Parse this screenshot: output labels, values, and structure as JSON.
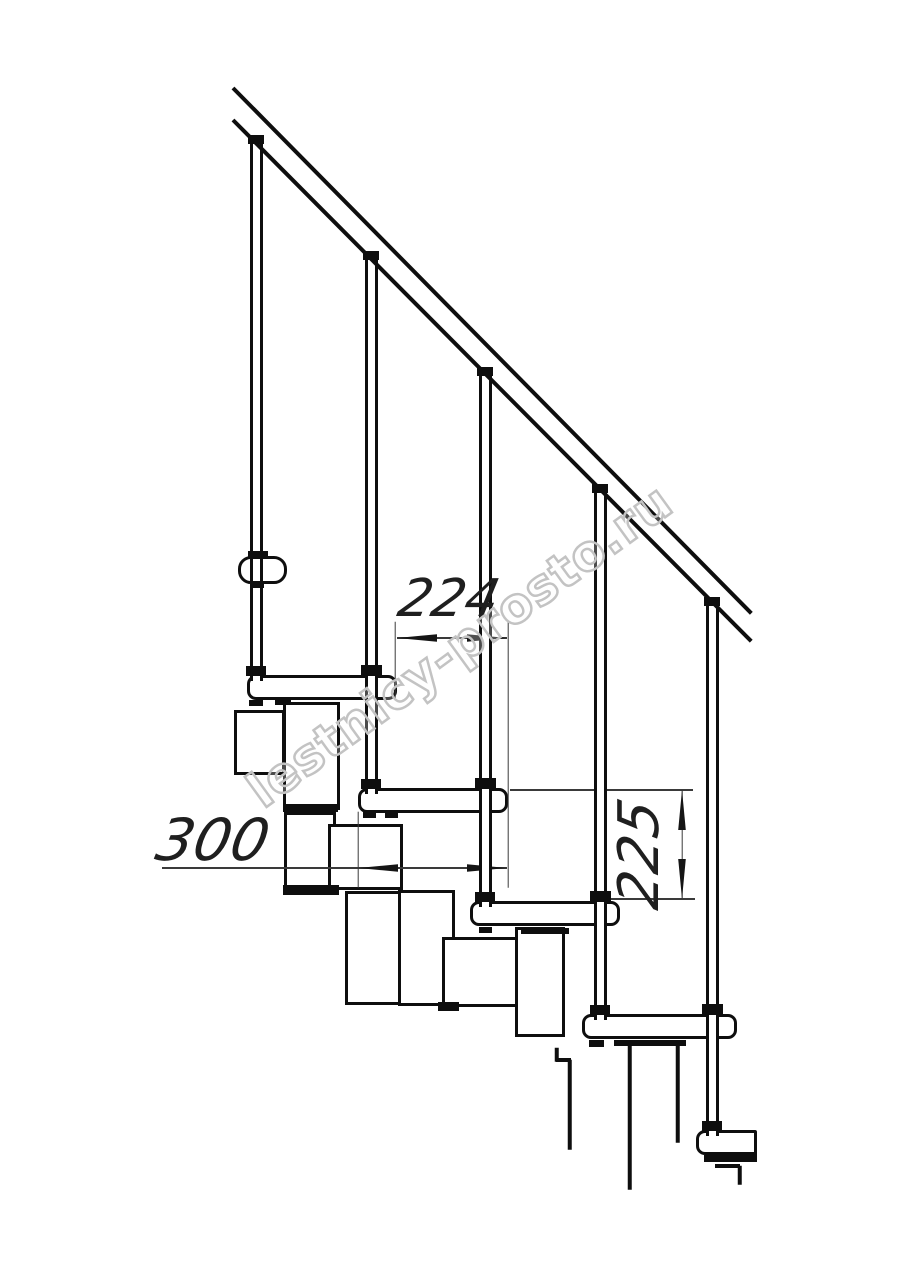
{
  "meta": {
    "description": "Technical side-view line drawing of a modular staircase with handrail, balusters, treads and central support modules",
    "background_color": "#ffffff",
    "object_line_color": "#0e0e0e",
    "thin_line_color": "#3a3a3a",
    "canvas": {
      "width": 914,
      "height": 1280
    }
  },
  "watermark": {
    "text": "lestnicy-prosto.ru",
    "center": {
      "x": 460,
      "y": 646
    },
    "angle_deg": -36,
    "font_size": 49,
    "letter_spacing": 1,
    "stroke_color": "#c3c3c3"
  },
  "dimensions": {
    "going": {
      "label": "224",
      "value_mm": 224,
      "text_center": {
        "x": 449,
        "y": 599
      },
      "font_size": 52,
      "rotate_deg": 0,
      "line": {
        "x1": 397,
        "y1": 638,
        "x2": 507,
        "y2": 638
      },
      "extension_lines": [
        {
          "x1": 395,
          "y1": 622,
          "x2": 395,
          "y2": 700
        },
        {
          "x1": 508,
          "y1": 622,
          "x2": 508,
          "y2": 888
        }
      ],
      "arrows": [
        {
          "x": 397,
          "y": 638,
          "dir": "left"
        },
        {
          "x": 507,
          "y": 638,
          "dir": "right"
        }
      ]
    },
    "tread_depth": {
      "label": "300",
      "value_mm": 300,
      "text_center": {
        "x": 213,
        "y": 840
      },
      "font_size": 58,
      "rotate_deg": 0,
      "line": {
        "x1": 162,
        "y1": 868,
        "x2": 507,
        "y2": 868
      },
      "extension_lines": [
        {
          "x1": 358,
          "y1": 812,
          "x2": 358,
          "y2": 888
        }
      ],
      "arrows": [
        {
          "x": 358,
          "y": 868,
          "dir": "left"
        },
        {
          "x": 507,
          "y": 868,
          "dir": "right"
        }
      ]
    },
    "rise": {
      "label": "225",
      "value_mm": 225,
      "text_center": {
        "x": 640,
        "y": 854
      },
      "font_size": 56,
      "rotate_deg": -90,
      "line": {
        "x1": 682,
        "y1": 790,
        "x2": 682,
        "y2": 899
      },
      "extension_lines": [
        {
          "x1": 510,
          "y1": 790,
          "x2": 693,
          "y2": 790
        },
        {
          "x1": 600,
          "y1": 899,
          "x2": 695,
          "y2": 899
        }
      ],
      "arrows": [
        {
          "x": 682,
          "y": 790,
          "dir": "up"
        },
        {
          "x": 682,
          "y": 899,
          "dir": "down"
        }
      ]
    }
  },
  "drawing": {
    "handrail": {
      "weight": 4,
      "upper": {
        "x1": 233,
        "y1": 88,
        "x2": 751,
        "y2": 613
      },
      "lower": {
        "x1": 233,
        "y1": 120,
        "x2": 751,
        "y2": 641
      }
    },
    "bracket_collar": {
      "x": 238,
      "y": 556,
      "w": 49,
      "h": 28
    },
    "balusters": [
      {
        "cx": 256,
        "top": 143,
        "bottom": 681
      },
      {
        "cx": 371,
        "top": 259,
        "bottom": 794
      },
      {
        "cx": 485,
        "top": 375,
        "bottom": 907
      },
      {
        "cx": 600,
        "top": 492,
        "bottom": 1020
      },
      {
        "cx": 712,
        "top": 605,
        "bottom": 1136
      }
    ],
    "baluster_width": 13,
    "treads": [
      {
        "x": 247,
        "y": 675,
        "w": 150,
        "h": 25,
        "r": "9px"
      },
      {
        "x": 358,
        "y": 788,
        "w": 150,
        "h": 25,
        "r": "9px"
      },
      {
        "x": 470,
        "y": 901,
        "w": 150,
        "h": 25,
        "r": "9px"
      },
      {
        "x": 582,
        "y": 1014,
        "w": 155,
        "h": 25,
        "r": "9px"
      },
      {
        "x": 696,
        "y": 1130,
        "w": 61,
        "h": 25,
        "r": "9px 2px 2px 9px"
      }
    ],
    "support_modules": [
      {
        "x": 234,
        "y": 710,
        "w": 51,
        "h": 65
      },
      {
        "x": 283,
        "y": 702,
        "w": 57,
        "h": 108
      },
      {
        "x": 284,
        "y": 812,
        "w": 52,
        "h": 82
      },
      {
        "x": 328,
        "y": 824,
        "w": 75,
        "h": 66
      },
      {
        "x": 345,
        "y": 891,
        "w": 58,
        "h": 114
      },
      {
        "x": 398,
        "y": 890,
        "w": 57,
        "h": 116
      },
      {
        "x": 442,
        "y": 937,
        "w": 78,
        "h": 70
      },
      {
        "x": 515,
        "y": 927,
        "w": 50,
        "h": 110
      }
    ],
    "black_fittings": [
      {
        "x": 248,
        "y": 135,
        "w": 16,
        "h": 9,
        "role": "rail-wedge"
      },
      {
        "x": 363,
        "y": 251,
        "w": 16,
        "h": 9,
        "role": "rail-wedge"
      },
      {
        "x": 477,
        "y": 367,
        "w": 16,
        "h": 9,
        "role": "rail-wedge"
      },
      {
        "x": 592,
        "y": 484,
        "w": 16,
        "h": 9,
        "role": "rail-wedge"
      },
      {
        "x": 704,
        "y": 597,
        "w": 16,
        "h": 9,
        "role": "rail-wedge"
      },
      {
        "x": 246,
        "y": 666,
        "w": 20,
        "h": 10,
        "role": "flange"
      },
      {
        "x": 361,
        "y": 665,
        "w": 21,
        "h": 11,
        "role": "flange"
      },
      {
        "x": 361,
        "y": 779,
        "w": 20,
        "h": 10,
        "role": "flange"
      },
      {
        "x": 475,
        "y": 778,
        "w": 21,
        "h": 11,
        "role": "flange"
      },
      {
        "x": 475,
        "y": 892,
        "w": 20,
        "h": 10,
        "role": "flange"
      },
      {
        "x": 590,
        "y": 891,
        "w": 21,
        "h": 11,
        "role": "flange"
      },
      {
        "x": 590,
        "y": 1005,
        "w": 20,
        "h": 10,
        "role": "flange"
      },
      {
        "x": 702,
        "y": 1004,
        "w": 21,
        "h": 11,
        "role": "flange"
      },
      {
        "x": 702,
        "y": 1121,
        "w": 20,
        "h": 10,
        "role": "flange"
      },
      {
        "x": 248,
        "y": 551,
        "w": 20,
        "h": 7,
        "role": "collar-cap"
      },
      {
        "x": 250,
        "y": 582,
        "w": 14,
        "h": 6,
        "role": "collar-cap"
      },
      {
        "x": 249,
        "y": 700,
        "w": 14,
        "h": 6,
        "role": "tread-foot"
      },
      {
        "x": 275,
        "y": 699,
        "w": 16,
        "h": 6,
        "role": "tread-foot"
      },
      {
        "x": 283,
        "y": 804,
        "w": 55,
        "h": 8,
        "role": "module-plate"
      },
      {
        "x": 283,
        "y": 885,
        "w": 56,
        "h": 10,
        "role": "module-plate"
      },
      {
        "x": 363,
        "y": 812,
        "w": 13,
        "h": 6,
        "role": "tread-foot"
      },
      {
        "x": 385,
        "y": 812,
        "w": 13,
        "h": 6,
        "role": "tread-foot"
      },
      {
        "x": 438,
        "y": 1002,
        "w": 21,
        "h": 9,
        "role": "module-plate"
      },
      {
        "x": 479,
        "y": 927,
        "w": 13,
        "h": 6,
        "role": "tread-foot"
      },
      {
        "x": 521,
        "y": 928,
        "w": 48,
        "h": 6,
        "role": "module-plate"
      },
      {
        "x": 589,
        "y": 1040,
        "w": 15,
        "h": 7,
        "role": "tread-foot"
      },
      {
        "x": 614,
        "y": 1040,
        "w": 72,
        "h": 6,
        "role": "module-plate"
      },
      {
        "x": 704,
        "y": 1155,
        "w": 24,
        "h": 7,
        "role": "tread-foot"
      },
      {
        "x": 724,
        "y": 1152,
        "w": 33,
        "h": 10,
        "role": "module-plate"
      }
    ],
    "cut_lines": [
      {
        "x1": 557,
        "y1": 1048,
        "x2": 557,
        "y2": 1062
      },
      {
        "x1": 556,
        "y1": 1060,
        "x2": 571,
        "y2": 1060
      },
      {
        "x1": 570,
        "y1": 1060,
        "x2": 570,
        "y2": 1150
      },
      {
        "x1": 630,
        "y1": 1046,
        "x2": 630,
        "y2": 1190
      },
      {
        "x1": 678,
        "y1": 1046,
        "x2": 678,
        "y2": 1143
      },
      {
        "x1": 715,
        "y1": 1166,
        "x2": 740,
        "y2": 1166
      },
      {
        "x1": 740,
        "y1": 1166,
        "x2": 740,
        "y2": 1185
      }
    ]
  }
}
